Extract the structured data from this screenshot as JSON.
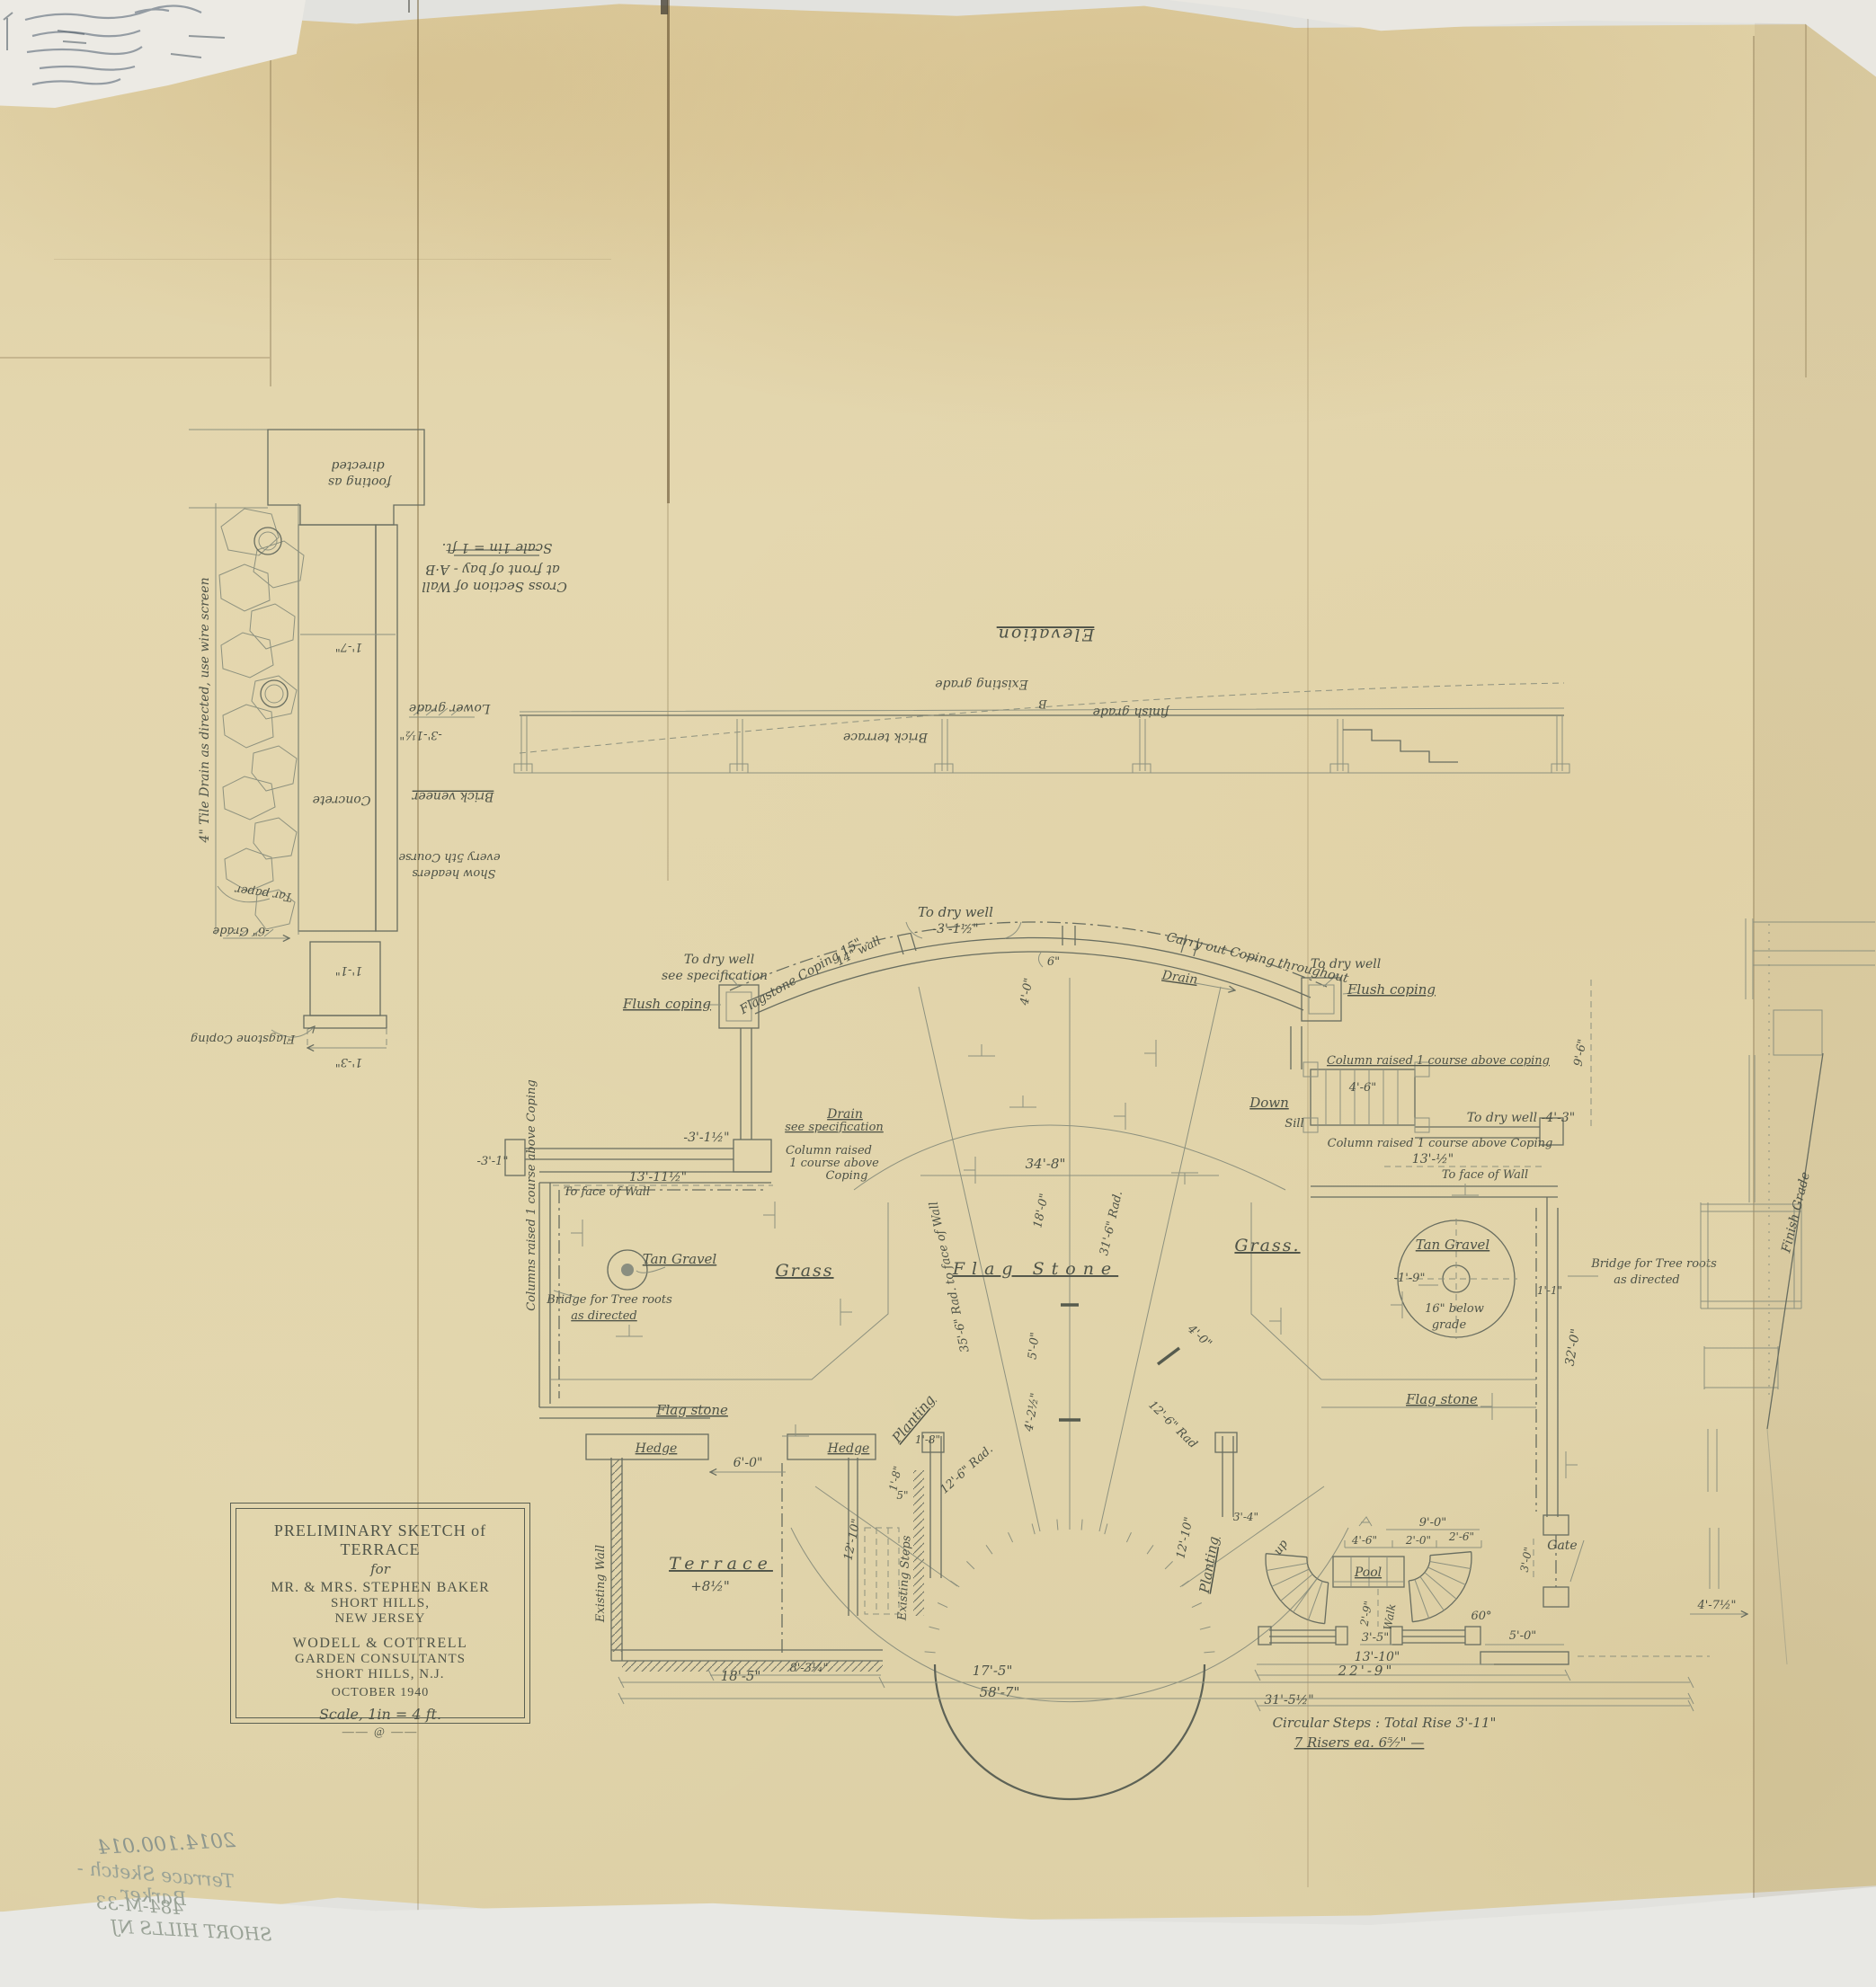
{
  "archive_notes": {
    "line1": "2014.100.014",
    "line2": "Terrace Sketch - Barker",
    "line3": "484-M-33",
    "line4": "SHORT HILLS NJ"
  },
  "title_block": {
    "line1": "PRELIMINARY SKETCH of TERRACE",
    "line2": "for",
    "line3": "MR. & MRS. STEPHEN BAKER",
    "line4": "SHORT HILLS,",
    "line5": "NEW JERSEY",
    "line6": "WODELL & COTTRELL",
    "line7": "GARDEN CONSULTANTS",
    "line8": "SHORT HILLS, N.J.",
    "line9": "OCTOBER 1940",
    "line10": "Scale, 1in = 4 ft.",
    "line11": "—— @ ——"
  },
  "cross_section": {
    "title1": "Cross Section of Wall",
    "title2": "at front of bay - A·B",
    "title3": "Scale 1in = 1 ft.",
    "tile_drain": "4\" Tile Drain as directed, use wire screen",
    "footing_1": "footing as",
    "footing_2": "directed",
    "lower_grade": "Lower grade",
    "dim_3_1h": "-3'-1½\"",
    "concrete": "Concrete",
    "brick_veneer": "Brick veneer",
    "headers_1": "Show headers",
    "headers_2": "every 5th Course",
    "tar_paper": "Tar paper",
    "grade_6": "-6\" Grade",
    "dim_1_7": "1'-7\"",
    "dim_1_1": "1'-1\"",
    "flagstone_coping": "Flagstone Coping",
    "dim_1_3": "1'-3\""
  },
  "elevation": {
    "title": "Elevation",
    "existing_grade": "Existing grade",
    "finish_grade": "finish grade",
    "brick_terrace": "Brick terrace",
    "b_mark": "B"
  },
  "right_detail": {
    "finish_grade": "Finish Grade"
  },
  "plan": {
    "areas": {
      "grass_left": "Grass",
      "grass_right": "Grass.",
      "flag_stone": "Flag Stone",
      "flag_stone_left": "Flag stone",
      "flag_stone_right": "Flag stone",
      "tan_gravel_left": "Tan Gravel",
      "tan_gravel_right": "Tan Gravel",
      "planting_left": "Planting",
      "planting_right": "Planting",
      "hedge_left": "Hedge",
      "hedge_right": "Hedge",
      "terrace": "Terrace",
      "terrace_elev": "+8½\"",
      "pool": "Pool",
      "walk": "Walk",
      "up": "up",
      "gate": "Gate",
      "down": "Down",
      "sill": "Sill",
      "existing_wall": "Existing Wall",
      "existing_steps": "Existing Steps"
    },
    "notes": {
      "to_dry_well_top": "To dry well",
      "dim_top": "-3'-1½\"",
      "flagstone_coping": "Flagstone Coping 15\"",
      "wall_14": "14\" wall",
      "to_dry_well_left": "To dry well",
      "see_spec_left": "see specification",
      "flush_coping_left": "Flush coping",
      "carry_out": "Carry out Coping throughout",
      "drain": "Drain",
      "to_dry_well_right": "To dry well",
      "flush_coping_right": "Flush coping",
      "col_raised_right_1": "Column raised 1 course above coping",
      "col_raised_right_2": "Column raised 1 course above Coping",
      "to_dry_well_4_3": "To dry well  -4'-3\"",
      "to_face_right": "To face of Wall",
      "drain_left": "Drain",
      "see_spec_left2": "see specification",
      "col_raised_l1": "Column raised",
      "col_raised_l2": "1 course above",
      "col_raised_l3": "Coping",
      "to_face_left": "To face of Wall",
      "columns_vert": "Columns raised 1 course above Coping",
      "bridge_left_1": "Bridge for Tree roots",
      "bridge_left_2": "as directed",
      "bridge_right_1": "Bridge for Tree roots",
      "bridge_right_2": "as directed",
      "below_grade_1": "16\" below",
      "below_grade_2": "grade",
      "steps_note_1": "Circular Steps : Total Rise 3'-11\"",
      "steps_note_2": "7 Risers ea. 6⁵⁄₇\" —"
    },
    "dims": {
      "d34_8": "34'-8\"",
      "d18_0": "18'-0\"",
      "rad_35_6": "35'-6\" Rad. to face of Wall",
      "rad_31_6": "31'-6\" Rad.",
      "rad_12_6_l": "12'-6\" Rad.",
      "rad_12_6_r": "12'-6\" Rad",
      "d5_0c": "5'-0\"",
      "d4_2h": "4'-2½\"",
      "d4_0l": "4'-0\"",
      "d4_0r": "4'-0\"",
      "d6": "6\"",
      "d13_11h": "13'-11½\"",
      "d3_1h_l": "-3'-1½\"",
      "d3_1": "-3'-1\"",
      "d13_h": "13'-½\"",
      "d4_6": "4'-6\"",
      "d9_6": "9'-6\"",
      "d32_0": "32'-0\"",
      "d1_9": "-1'-9\"",
      "d1_1": "1'-1\"",
      "d6_0": "6'-0\"",
      "d1_8a": "1'-8\"",
      "d1_8b": "1'-8\"",
      "d5": "5\"",
      "d12_10l": "12'-10\"",
      "d12_10r": "12'-10\"",
      "d3_4": "3'-4\"",
      "d9_0": "9'-0\"",
      "d4_6p": "4'-6\"",
      "d2_0": "2'-0\"",
      "d2_6": "2'-6\"",
      "d2_9": "2'-9\"",
      "d60": "60°",
      "d3_5": "3'-5\"",
      "d5_0g": "5'-0\"",
      "d3_0": "3'-0\"",
      "d13_10": "13'-10\"",
      "d22_9": "22'-9\"",
      "d18_5": "18'-5\"",
      "d8_3q": "8'-3¼\"",
      "d17_5": "17'-5\"",
      "d58_7": "58'-7\"",
      "d31_5h": "31'-5½\"",
      "d4_7h": "4'-7½\""
    }
  }
}
